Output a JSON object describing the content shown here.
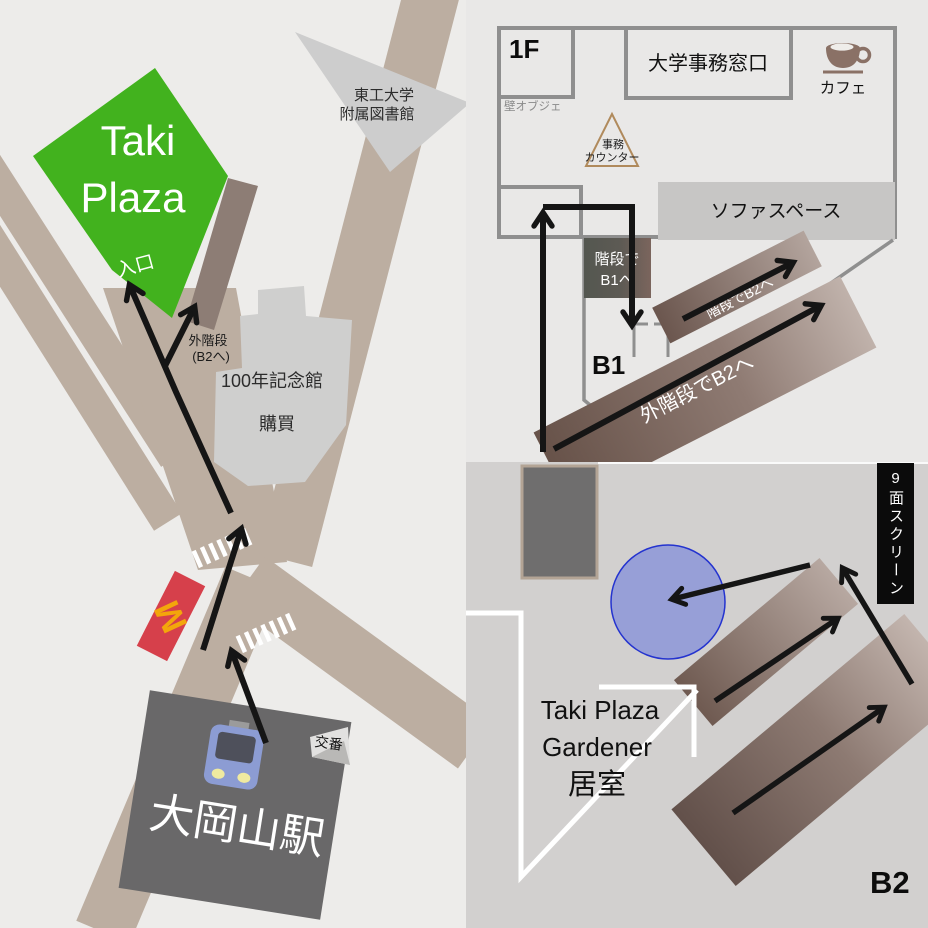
{
  "map": {
    "taki_plaza": {
      "line1": "Taki",
      "line2": "Plaza",
      "entrance": "入口"
    },
    "outdoor_stairs": {
      "line1": "外階段",
      "line2": "(B2へ)"
    },
    "library": {
      "line1": "東工大学",
      "line2": "附属図書館"
    },
    "memorial": {
      "line1": "100年記念館",
      "line2": "購買"
    },
    "mcdonalds_m": "M",
    "station": "大岡山駅",
    "koban": "交番"
  },
  "f1": {
    "label": "1F",
    "office": "大学事務窓口",
    "wall_object": "壁オブジェ",
    "counter": {
      "line1": "事務",
      "line2": "カウンター"
    },
    "cafe": "カフェ",
    "sofa": "ソファスペース",
    "stairs_b1": {
      "line1": "階段で",
      "line2": "B1へ"
    },
    "b1": "B1",
    "stairs_b2": "階段でB2へ",
    "outdoor_stairs_b2": "外階段でB2へ"
  },
  "b2": {
    "gardener": {
      "line1": "Taki Plaza",
      "line2": "Gardener",
      "line3": "居室"
    },
    "screen": "9面スクリーン",
    "label": "B2"
  },
  "colors": {
    "taki_green": "#42b21e",
    "road": "#bcaea1",
    "mcdonalds_red": "#d6404b",
    "mcdonalds_yellow": "#f3a60b",
    "station_grey": "#696869",
    "building_brown": "#8d7d75",
    "circle_blue": "#5b6ee0",
    "banner_black": "#0b0b0b"
  }
}
